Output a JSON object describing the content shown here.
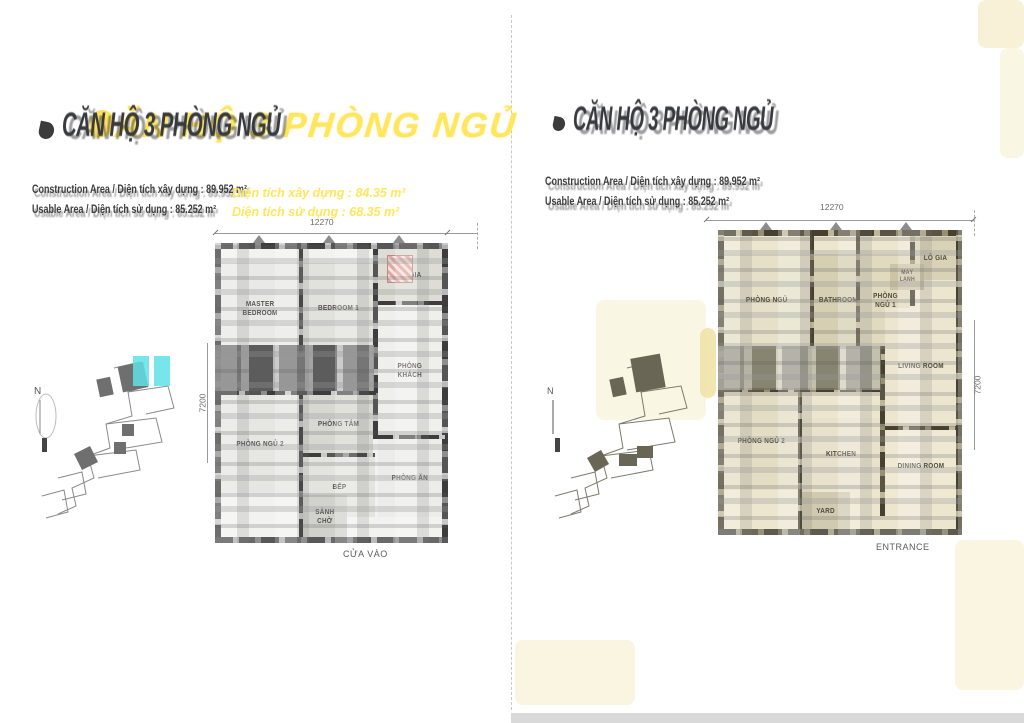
{
  "page": {
    "separator_color": "#c8c8c8",
    "tint_color": "#f6eecd",
    "footer_bar_color": "#d9d9d9"
  },
  "colors": {
    "accent_yellow": "#ffe65c",
    "highlight_cyan": "#5fe0e6",
    "wall_dark": "#3d3d3d",
    "wall_olive": "#46412f",
    "hatch_pink": "#e2a9a1"
  },
  "left_panel": {
    "title_dark": "CĂN HỘ 3 PHÒNG NGỦ",
    "title_yellow": "CĂN HỘ 3 PHÒNG NGỦ",
    "info": {
      "line1_black": "Construction Area / Diện tích xây dựng : 89.952 m²",
      "line1_yellow": "Diện tích xây dựng : 84.35 m²",
      "line2_black": "Usable Area / Diện tích sử dụng : 85.252 m²",
      "line2_yellow": "Diện tích sử dụng : 68.35 m²"
    },
    "keyplan": {
      "north": "N"
    },
    "plan": {
      "dim_top": "12270",
      "dim_side": "7200",
      "entrance": "CỬA VÀO",
      "rooms": {
        "master_bedroom": "MASTER BEDROOM",
        "bedroom1": "BEDROOM 1",
        "logia": "LÔ GIA",
        "living": "PHÒNG KHÁCH",
        "bathroom": "PHÒNG TẮM",
        "bedroom2": "PHÒNG NGỦ 2",
        "kitchen": "BẾP",
        "dining": "PHÒNG ĂN",
        "lobby": "SẢNH CHỜ"
      }
    }
  },
  "right_panel": {
    "title_dark": "CĂN HỘ 3 PHÒNG NGỦ",
    "info": {
      "line1_black": "Construction Area / Diện tích xây dựng : 89.952 m²",
      "line2_black": "Usable Area / Diện tích sử dụng : 85.252 m²"
    },
    "keyplan": {
      "north": "N"
    },
    "plan": {
      "dim_top": "12270",
      "dim_side": "7200",
      "entrance": "ENTRANCE",
      "rooms": {
        "bedroom": "PHÒNG NGỦ",
        "bathroom": "BATHROOM",
        "bedroom1": "PHÒNG NGỦ 1",
        "logia": "LÔ GIA",
        "aircon": "MÁY LẠNH",
        "living": "LIVING ROOM",
        "bedroom2": "PHÒNG NGỦ 2",
        "kitchen": "KITCHEN",
        "dining": "DINING ROOM",
        "yard": "YARD"
      }
    }
  }
}
